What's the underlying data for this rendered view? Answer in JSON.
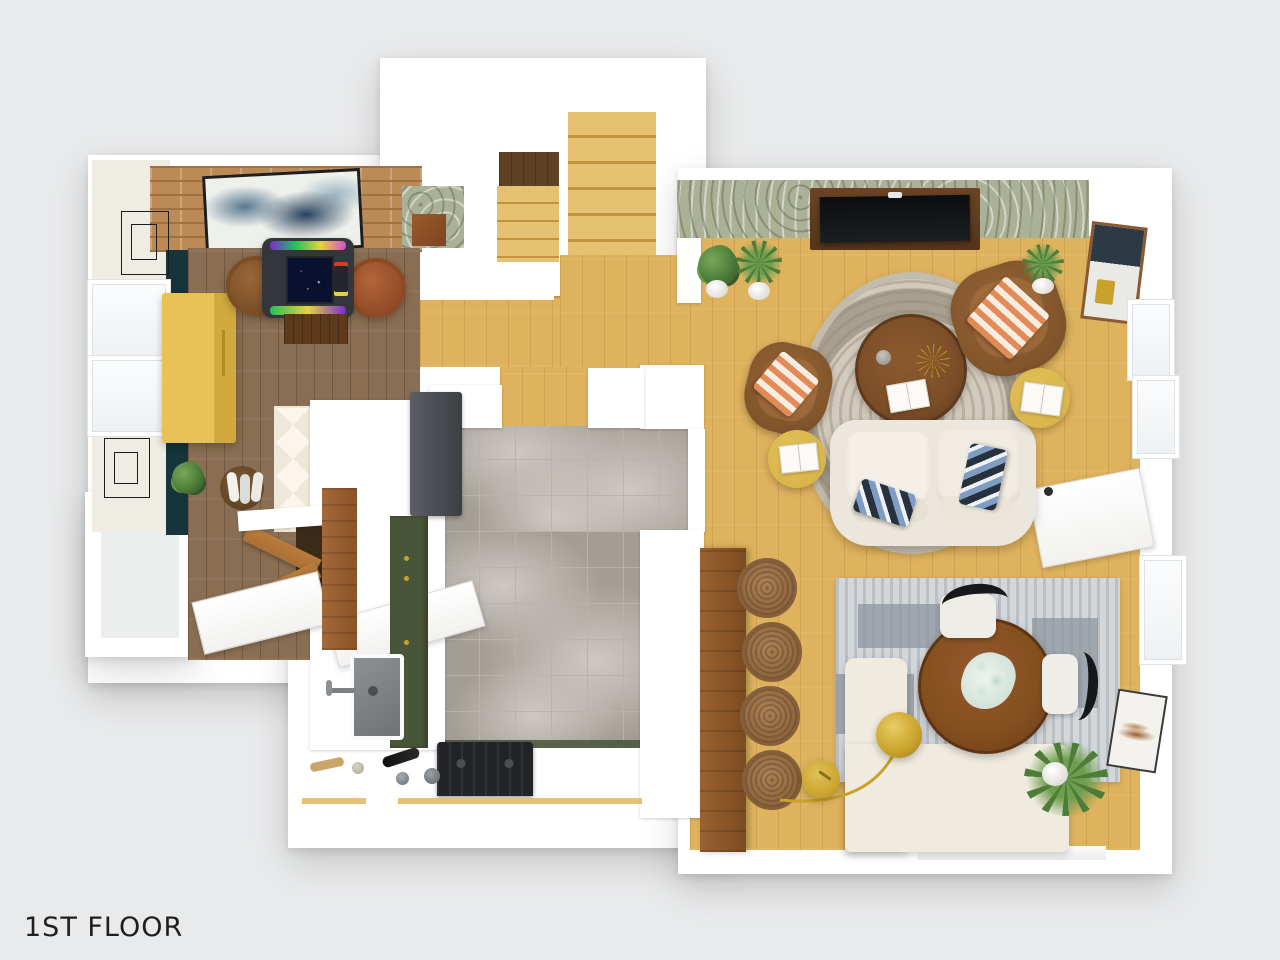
{
  "floor_label": "1ST FLOOR",
  "palette": {
    "bg": "#e9eaeb",
    "wall": "#ffffff",
    "wall-soft": "#f2f1ef",
    "text": "#1f1f1f",
    "oak": "#dfb25e",
    "oak-light": "#e6c171",
    "oak-line": "#c2943f",
    "wood": "#8a6e53",
    "wood-dark": "#5f4226",
    "teal": "#16343a",
    "brick": "#bb8a57",
    "brick-line": "#a0713f",
    "beige-wall": "#efece4",
    "yellow": "#e8c257",
    "yellow-side": "#d2a93c",
    "mustard": "#d9b64b",
    "olive": "#485538",
    "steel": "#5b5f63",
    "steel-dark": "#3b3f43",
    "tile": "#a39d95",
    "tile-line": "#b8b3ab",
    "tile-vein": "#cdc9c2",
    "walnut": "#7c4e28",
    "walnut-dark": "#5e3a1c",
    "cognac": "#9a6638",
    "cognac-dark": "#7a4f27",
    "terracotta": "#b4643a",
    "cream": "#ece7dc",
    "banquette": "#f0ebdf",
    "rug-base": "#d2cabc",
    "rug-pattern": "#a89f90",
    "srug-a": "#d4d7da",
    "srug-b": "#b9bfc5",
    "srug-c": "#8e969e",
    "navy": "#27323e",
    "blue-light": "#7f9cc2",
    "orange": "#e28a58",
    "sage": "#abb197",
    "gold": "#c9a22b",
    "gold-dark": "#b08a22",
    "green": "#4e7d3a",
    "green-dark": "#35592a",
    "mint": "#cfe6da",
    "black": "#141518",
    "charcoal": "#33363b",
    "rattan": "#ab8155",
    "rattan-dark": "#85603a",
    "brown-door": "#b97c3d",
    "frame-black": "#1c1c1c"
  },
  "rooms": {
    "game_room": {
      "items": [
        "brick-accent-wall",
        "abstract-wall-art",
        "teal-accent-wall",
        "yellow-credenza",
        "arcade-cocktail-table",
        "leather-stool",
        "leather-stool",
        "potted-plant",
        "blanket-basket",
        "gallery-frames",
        "diamond-runner-rug"
      ]
    },
    "entry": {
      "items": [
        "bifold-closet",
        "front-door",
        "porch",
        "window"
      ]
    },
    "stair_hall": {
      "items": [
        "upper-stair-flight",
        "lower-stair-flight",
        "stair-landing",
        "powder-room",
        "oak-hallway"
      ]
    },
    "kitchen": {
      "items": [
        "refrigerator",
        "olive-cabinet-run",
        "wood-countertop",
        "sink",
        "faucet",
        "gas-range",
        "wine-bottles",
        "marble-tile-floor",
        "peninsula-wall",
        "bar-counter"
      ]
    },
    "living_room": {
      "items": [
        "botanical-wallpaper",
        "media-console",
        "tv",
        "round-ornate-rug",
        "round-coffee-table",
        "vase",
        "starburst-decor",
        "magazine",
        "cream-sofa",
        "blue-pillows",
        "leather-armchair",
        "leather-armchair",
        "striped-pillow",
        "striped-pillow",
        "mustard-side-table",
        "mustard-side-table",
        "open-book",
        "open-book",
        "fiddle-leaf-plant",
        "fern-plant",
        "potted-plant",
        "framed-abstract-art",
        "windows"
      ]
    },
    "dining_room": {
      "items": [
        "striped-area-rug",
        "round-dining-table",
        "eucalyptus-centerpiece",
        "dining-chair",
        "dining-chair",
        "l-shaped-banquette",
        "rattan-bar-stools",
        "arc-floor-lamp",
        "gold-side-table",
        "palm-plant",
        "framed-art",
        "open-entry-door",
        "windows"
      ]
    }
  }
}
